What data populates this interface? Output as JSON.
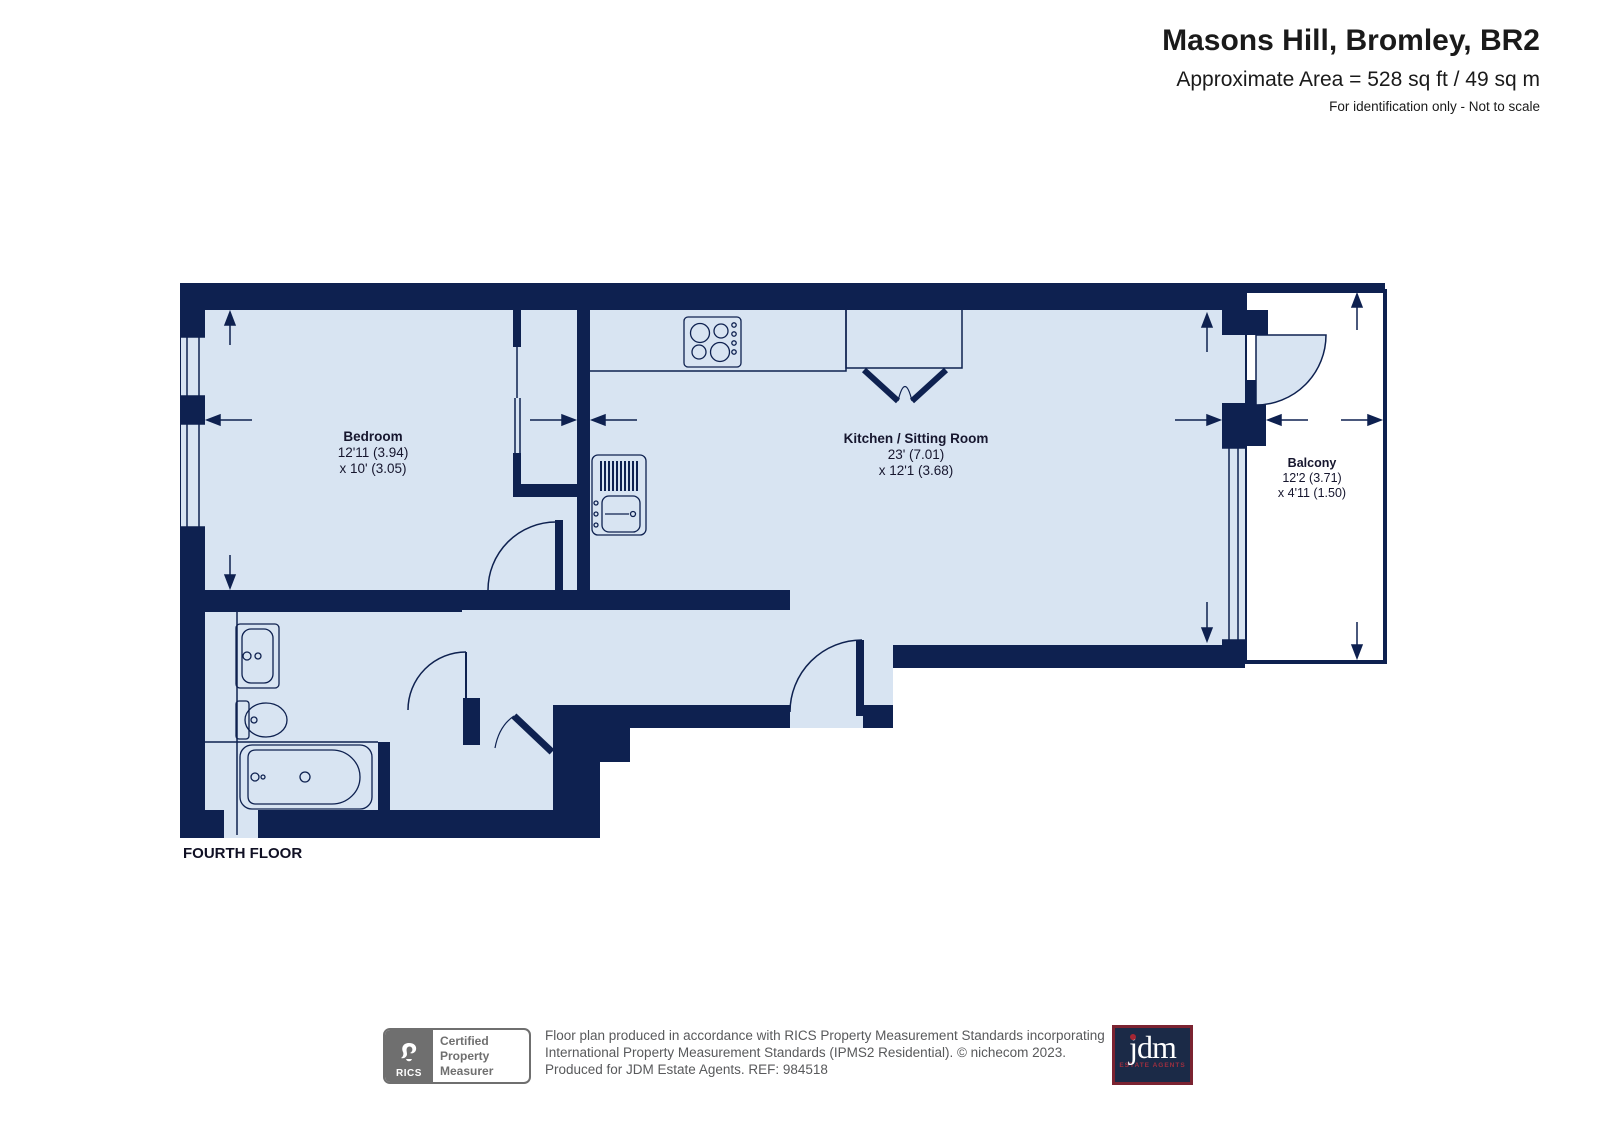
{
  "header": {
    "title": "Masons Hill, Bromley, BR2",
    "area": "Approximate Area = 528 sq ft / 49 sq m",
    "note": "For identification only - Not to scale"
  },
  "floor_label": "FOURTH FLOOR",
  "rooms": {
    "bedroom": {
      "name": "Bedroom",
      "dim1": "12'11 (3.94)",
      "dim2": "x 10' (3.05)"
    },
    "kitchen": {
      "name": "Kitchen / Sitting Room",
      "dim1": "23' (7.01)",
      "dim2": "x 12'1 (3.68)"
    },
    "balcony": {
      "name": "Balcony",
      "dim1": "12'2 (3.71)",
      "dim2": "x 4'11 (1.50)"
    }
  },
  "footer": {
    "rics_logo_text": "RICS",
    "rics_label_line1": "Certified",
    "rics_label_line2": "Property",
    "rics_label_line3": "Measurer",
    "disclaimer_line1": "Floor plan produced in accordance with RICS Property Measurement Standards incorporating",
    "disclaimer_line2": "International Property Measurement Standards (IPMS2 Residential).   © nichecom 2023.",
    "disclaimer_line3": "Produced for JDM Estate Agents.   REF: 984518",
    "jdm_logo_text": "jdm",
    "jdm_sub_text": "ESTATE AGENTS"
  },
  "colors": {
    "wall_navy": "#0e2150",
    "room_fill": "#d8e4f2",
    "balcony_fill": "#ffffff",
    "text_dark": "#16162e",
    "footer_gray": "#58595b",
    "jdm_navy": "#1b2a47",
    "jdm_maroon": "#7b2331"
  }
}
